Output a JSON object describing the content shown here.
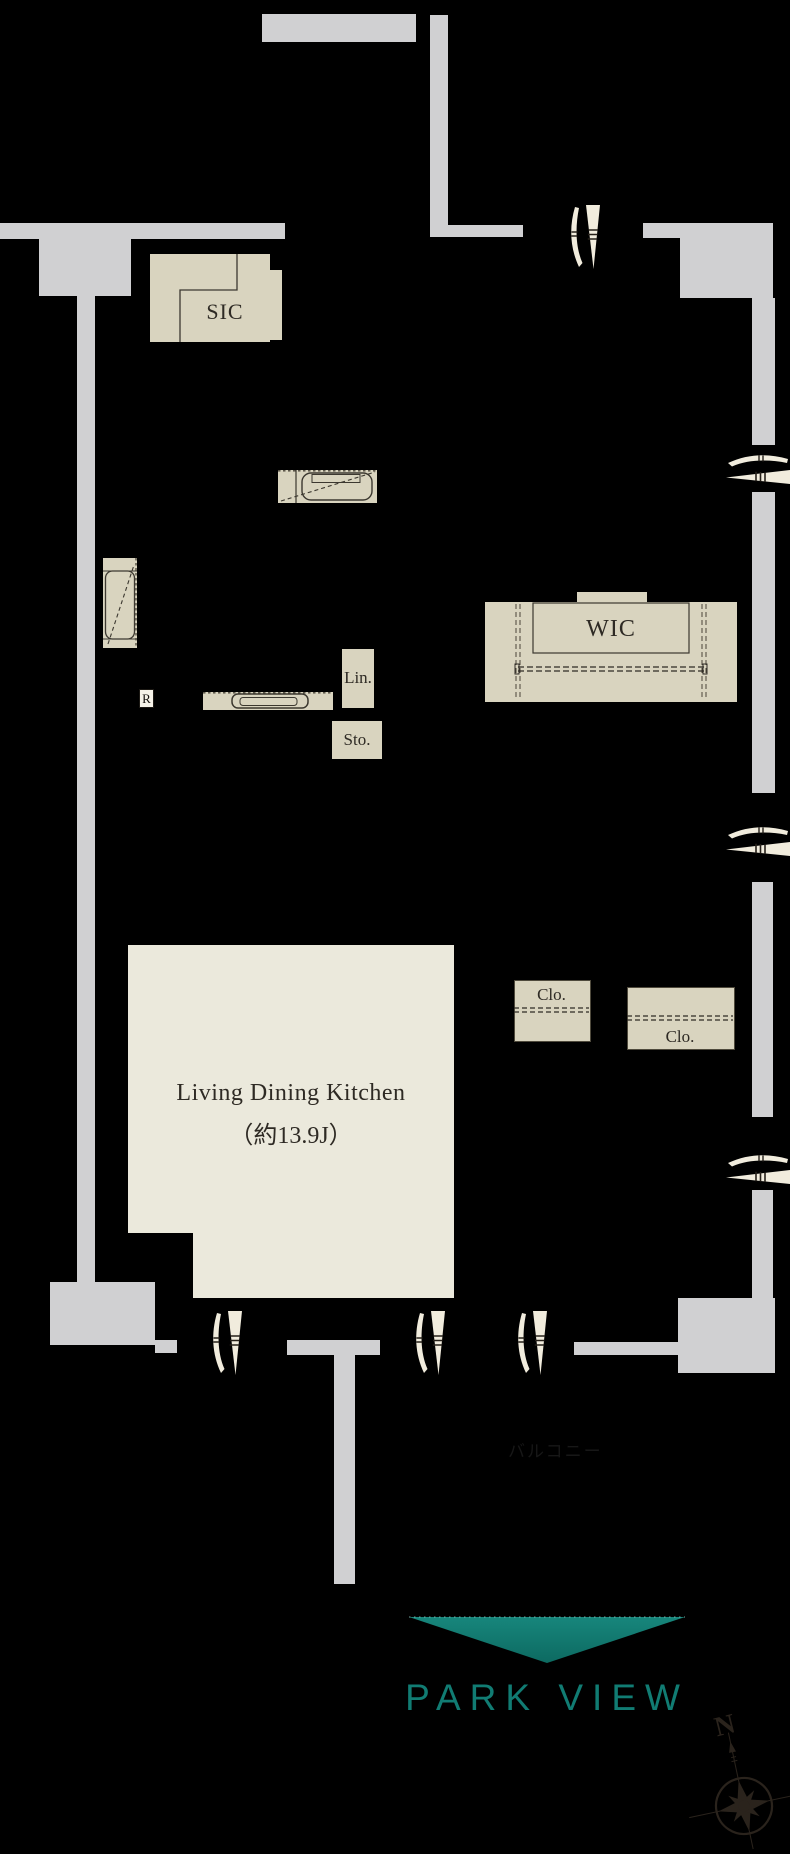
{
  "labels": {
    "sic": "SIC",
    "wic": "WIC",
    "linen": "Lin.",
    "storage": "Sto.",
    "closet_a": "Clo.",
    "closet_b": "Clo.",
    "refrigerator": "R",
    "ldk_name": "Living Dining Kitchen",
    "ldk_size": "（約13.9J）",
    "balcony": "バルコニー",
    "view_caption": "PARK VIEW",
    "compass_north": "N"
  },
  "colors": {
    "background": "#000000",
    "wall": "#d0d0d2",
    "fixture_beige": "#d9d4bf",
    "room_cream": "#ebe9dc",
    "door_symbol_ivory": "#f1ecdd",
    "accent_teal": "#117c73",
    "detail_line": "#4a453a",
    "compass_dark": "#2a231c"
  }
}
